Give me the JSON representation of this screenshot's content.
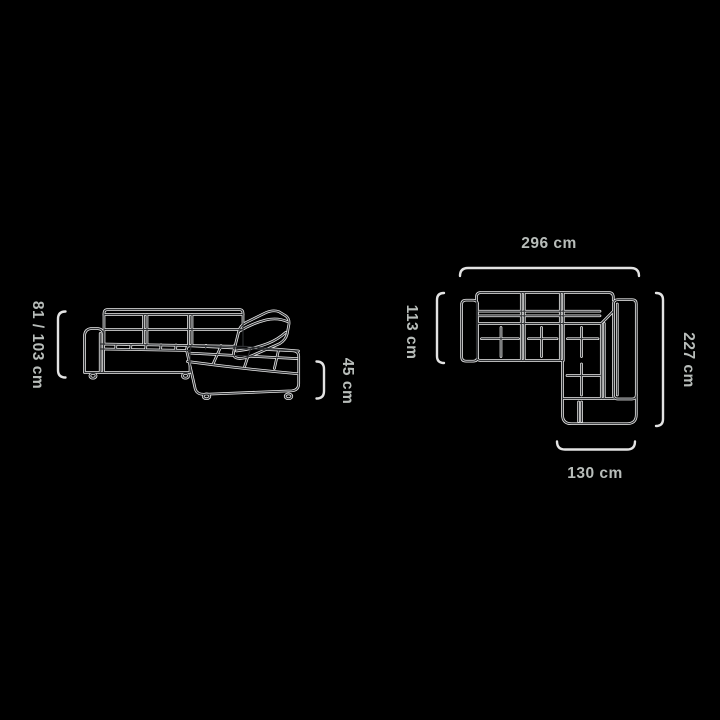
{
  "colors": {
    "background": "#000000",
    "sofa_line_halo": "#ebebeb",
    "sofa_line_core": "#2e3033",
    "dimension_line": "#e3e3e3",
    "label_text": "#b8bdba"
  },
  "side_view": {
    "height_label": "81 / 103 cm",
    "seat_height_label": "45 cm"
  },
  "top_view": {
    "width_label": "296 cm",
    "depth_label": "113 cm",
    "length_label": "227 cm",
    "chaise_width_label": "130 cm"
  }
}
